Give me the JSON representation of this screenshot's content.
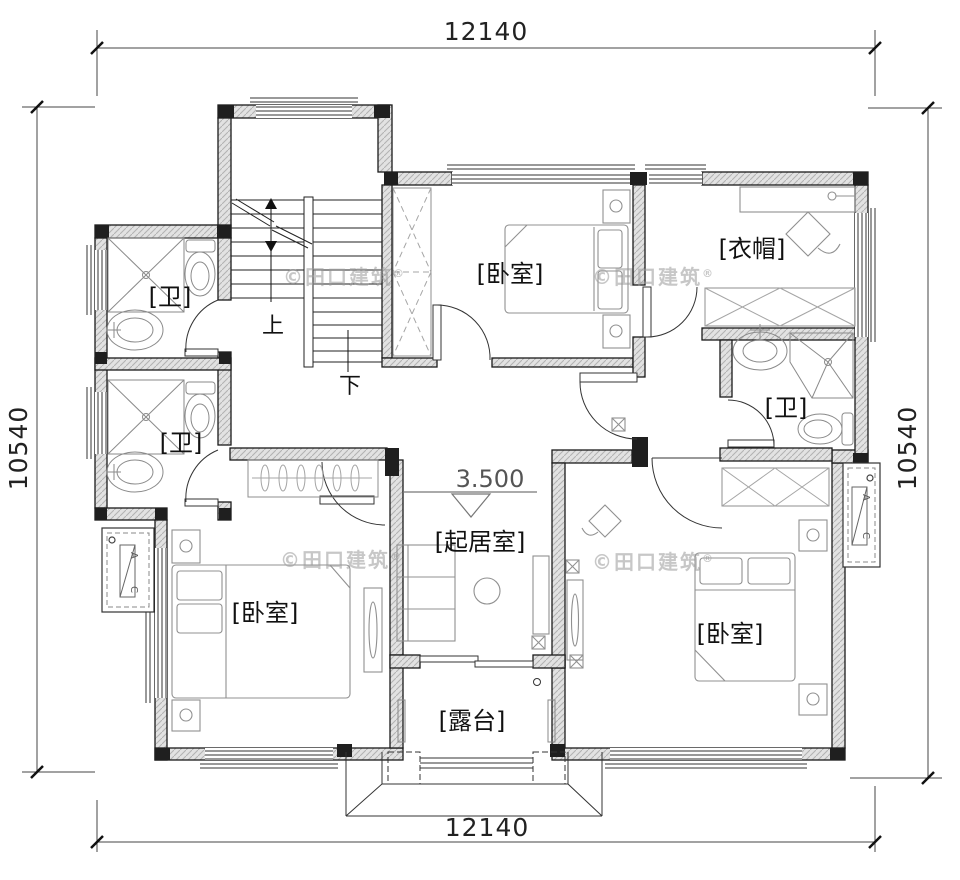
{
  "drawing": {
    "title_hint": "floor-plan",
    "dimensions": {
      "top": "12140",
      "bottom": "12140",
      "left": "10540",
      "right": "10540"
    },
    "level_marker": "3.500",
    "rooms": {
      "bedroom_top": "[卧室]",
      "bedroom_left": "[卧室]",
      "bedroom_right": "[卧室]",
      "cloakroom": "[衣帽]",
      "bath_left_upper": "[卫]",
      "bath_left_lower": "[卫]",
      "bath_right": "[卫]",
      "living_room": "[起居室]",
      "terrace": "[露台]"
    },
    "stairs": {
      "up": "上",
      "down": "下"
    },
    "ac_unit": {
      "a": "A",
      "c": "C"
    },
    "watermark": {
      "text": "©田口建筑",
      "reg": "®"
    },
    "colors": {
      "wall_fill": "#dcdcdc",
      "line": "#1a1a1a",
      "column": "#1f1f1f",
      "furniture": "#909090",
      "watermark": "#9b9b9b"
    }
  }
}
